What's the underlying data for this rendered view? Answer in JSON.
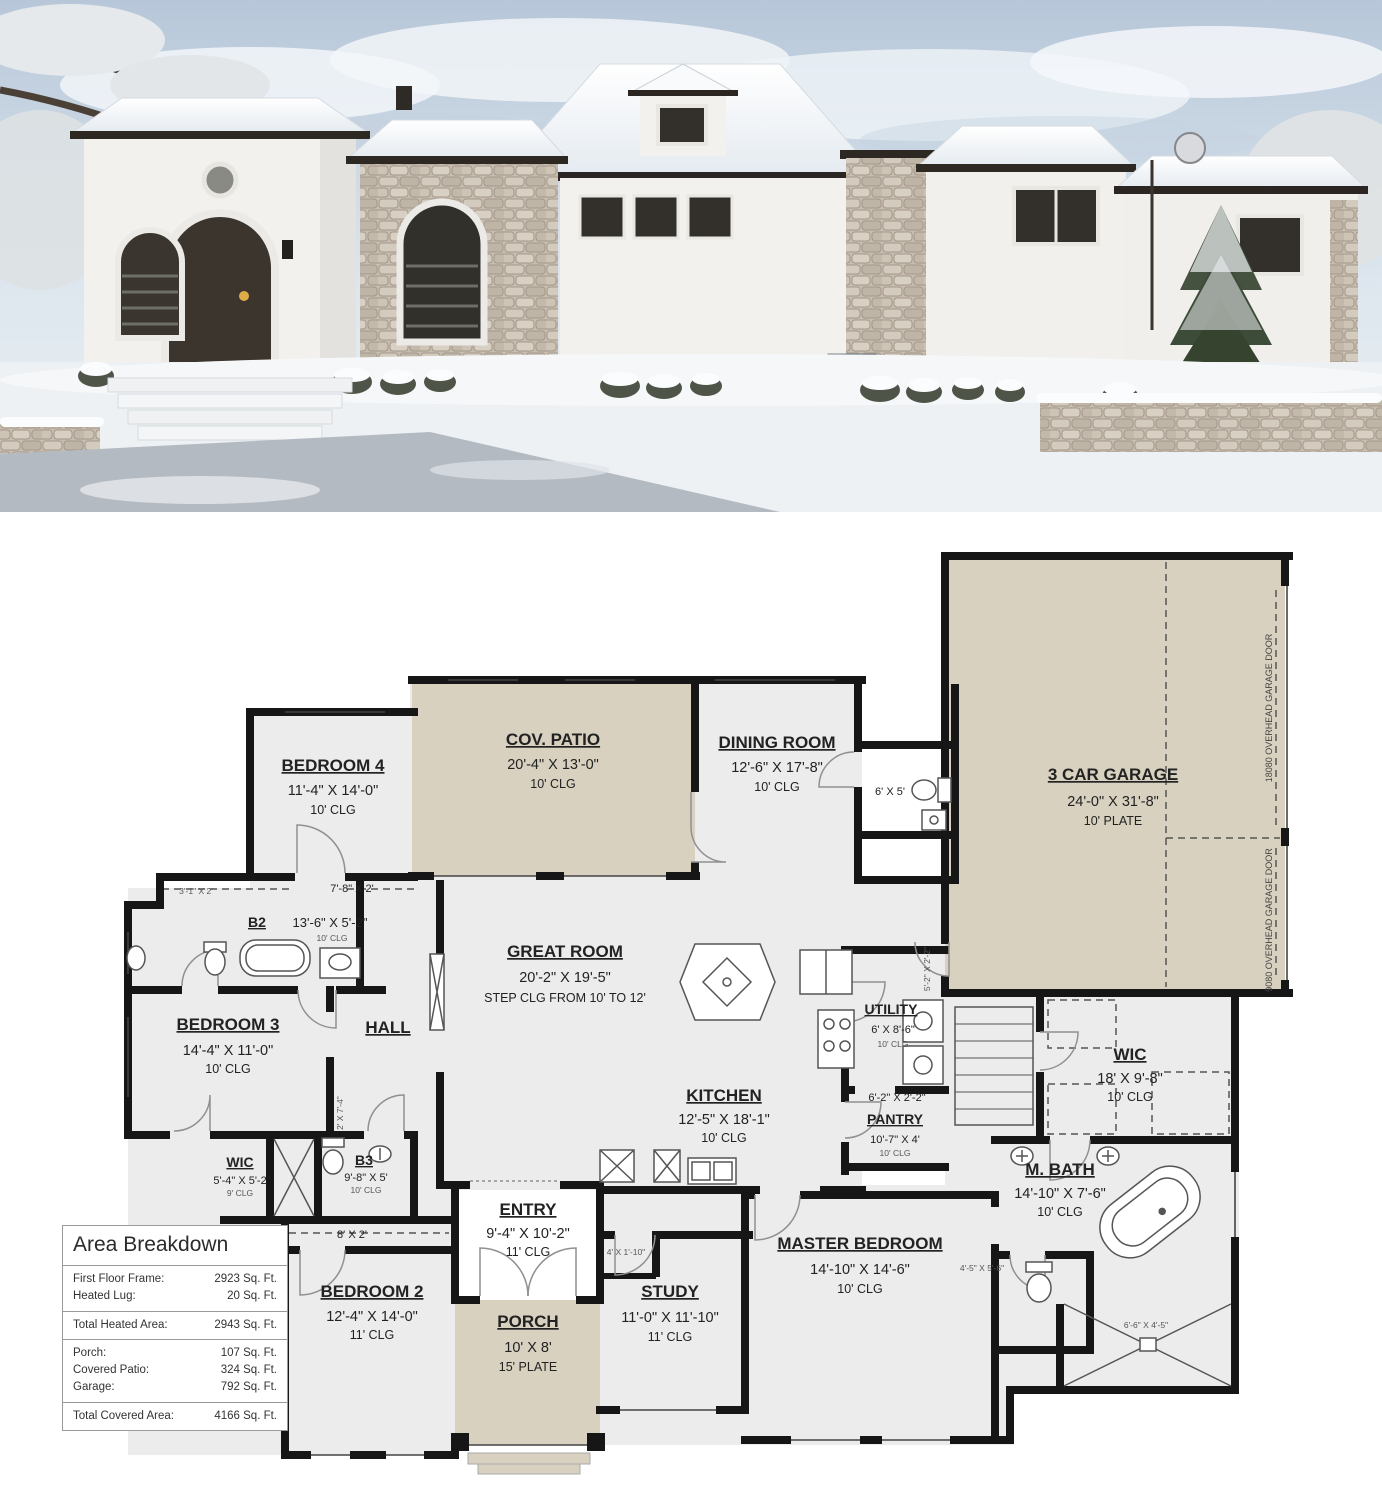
{
  "colors": {
    "plan_wall": "#161616",
    "room_fill": "#ececec",
    "patio_fill": "#d8d1c0"
  },
  "plan": {
    "rooms": [
      {
        "name": "BEDROOM 4",
        "dim": "11'-4\" X 14'-0\"",
        "note": "10' CLG"
      },
      {
        "name": "COV. PATIO",
        "dim": "20'-4\" X 13'-0\"",
        "note": "10' CLG"
      },
      {
        "name": "DINING ROOM",
        "dim": "12'-6\" X 17'-8\"",
        "note": "10' CLG"
      },
      {
        "name": "3 CAR GARAGE",
        "dim": "24'-0\" X 31'-8\"",
        "note": "10' PLATE"
      },
      {
        "name": "GREAT ROOM",
        "dim": "20'-2\" X 19'-5\"",
        "note": "STEP CLG FROM 10' TO 12'"
      },
      {
        "name": "KITCHEN",
        "dim": "12'-5\" X 18'-1\"",
        "note": "10' CLG"
      },
      {
        "name": "UTILITY",
        "dim": "6' X 8'-6\"",
        "note": "10' CLG"
      },
      {
        "name": "PANTRY",
        "dim": "10'-7\" X 4'",
        "note": "10' CLG"
      },
      {
        "name": "WIC",
        "dim": "18' X 9'-8\"",
        "note": "10' CLG"
      },
      {
        "name": "M. BATH",
        "dim": "14'-10\" X 7'-6\"",
        "note": "10' CLG"
      },
      {
        "name": "MASTER BEDROOM",
        "dim": "14'-10\" X 14'-6\"",
        "note": "10' CLG"
      },
      {
        "name": "STUDY",
        "dim": "11'-0\" X 11'-10\"",
        "note": "11' CLG"
      },
      {
        "name": "ENTRY",
        "dim": "9'-4\" X 10'-2\"",
        "note": "11' CLG"
      },
      {
        "name": "PORCH",
        "dim": "10' X 8'",
        "note": "15' PLATE"
      },
      {
        "name": "BEDROOM 2",
        "dim": "12'-4\" X 14'-0\"",
        "note": "11' CLG"
      },
      {
        "name": "BEDROOM 3",
        "dim": "14'-4\" X 11'-0\"",
        "note": "10' CLG"
      },
      {
        "name": "HALL",
        "dim": "",
        "note": ""
      },
      {
        "name": "B2",
        "dim": "13'-6\" X 5'-2\"",
        "note": "10' CLG"
      },
      {
        "name": "B3",
        "dim": "9'-8\" X 5'",
        "note": "10' CLG"
      },
      {
        "name": "WIC",
        "dim": "5'-4\" X 5'-2\"",
        "note": "9' CLG"
      }
    ],
    "labels": [
      "6' X 5'",
      "3'-1\" X 2'",
      "7'-8\" X 2'",
      "6'-2\" X 2'-2\"",
      "4'-5\" X 5'-6\"",
      "4' X 1'-10\"",
      "8' X 2'",
      "6'-6\" X 4'-5\"",
      "2' X 7'-4\"",
      "5'-2\" X 2'-2\""
    ],
    "garage_doors": [
      "18080 OVERHEAD GARAGE DOOR",
      "9080 OVERHEAD GARAGE DOOR"
    ]
  },
  "area_breakdown": {
    "title": "Area Breakdown",
    "groups": [
      {
        "rows": [
          {
            "label": "First Floor Frame:",
            "value": "2923 Sq. Ft."
          },
          {
            "label": "Heated Lug:",
            "value": "20 Sq. Ft."
          }
        ]
      },
      {
        "rows": [
          {
            "label": "Total Heated Area:",
            "value": "2943 Sq. Ft."
          }
        ]
      },
      {
        "rows": [
          {
            "label": "Porch:",
            "value": "107 Sq. Ft."
          },
          {
            "label": "Covered Patio:",
            "value": "324 Sq. Ft."
          },
          {
            "label": "Garage:",
            "value": "792 Sq. Ft."
          }
        ]
      },
      {
        "rows": [
          {
            "label": "Total Covered Area:",
            "value": "4166 Sq. Ft."
          }
        ]
      }
    ]
  }
}
